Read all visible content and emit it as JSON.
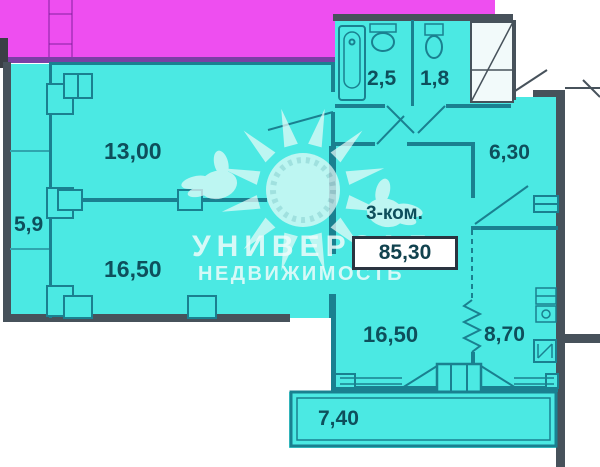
{
  "plan": {
    "type_label": "3-ком.",
    "total_area": "85,30",
    "rooms": [
      {
        "name": "bedroom-top",
        "area": "13,00"
      },
      {
        "name": "loggia-left",
        "area": "5,9"
      },
      {
        "name": "living-left",
        "area": "16,50"
      },
      {
        "name": "bathroom",
        "area": "2,5"
      },
      {
        "name": "wc",
        "area": "1,8"
      },
      {
        "name": "hallway",
        "area": "6,30"
      },
      {
        "name": "bedroom-right",
        "area": "16,50"
      },
      {
        "name": "kitchen",
        "area": "8,70"
      },
      {
        "name": "balcony-bottom",
        "area": "7,40"
      }
    ],
    "watermark": {
      "line1": "УНИВЕРСАЛ",
      "line2": "НЕДВИЖИМОСТЬ"
    },
    "colors": {
      "apartment_fill": "#4BE9E3",
      "neighbor_fill": "#EE4EF0",
      "wall_teal": "#1A8090",
      "wall_dark": "#47525B",
      "label_text": "#0E4F5C"
    }
  }
}
